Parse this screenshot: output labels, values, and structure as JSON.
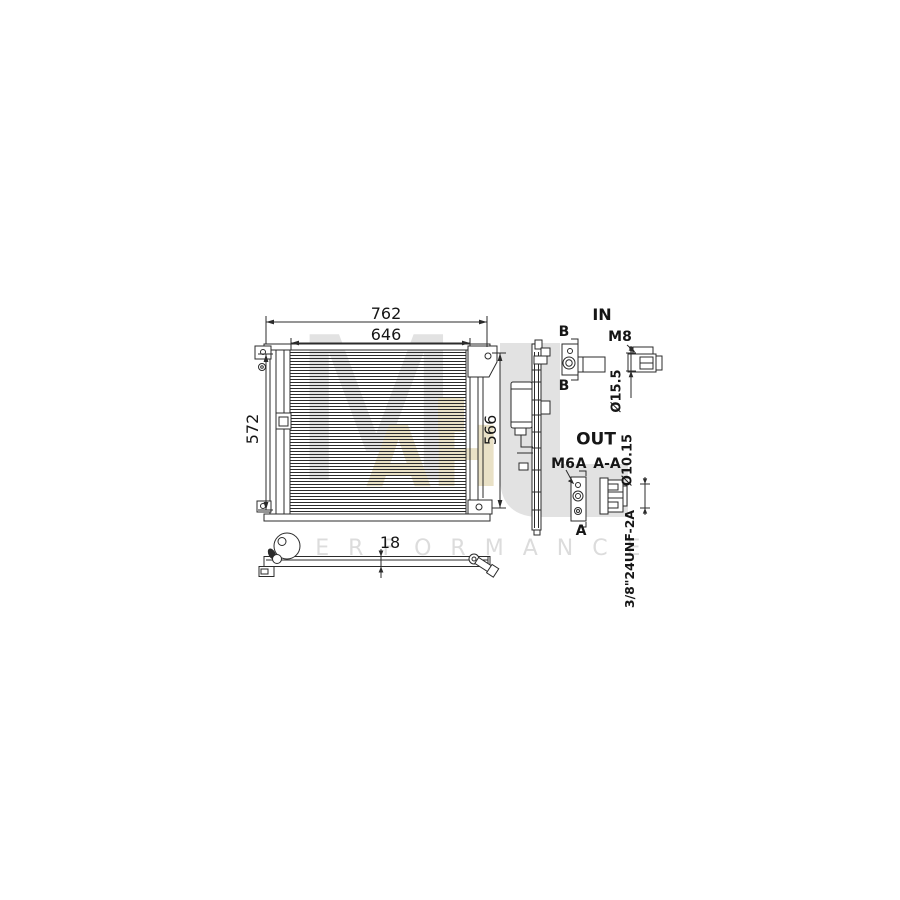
{
  "drawing": {
    "dim_overall_width": "762",
    "dim_core_width": "646",
    "dim_left_height": "572",
    "dim_right_height": "566",
    "dim_depth": "18",
    "inlet": {
      "title": "IN",
      "section_top": "B",
      "section_bottom": "B",
      "thread": "M8",
      "diameter": "Ø15.5"
    },
    "outlet": {
      "title": "OUT",
      "thread": "M6",
      "section_top": "A",
      "section_bottom": "A",
      "section_view": "A-A",
      "diameter": "Ø10.15",
      "fitting_thread": "3/8\"24UNF-2A"
    }
  },
  "watermark": {
    "letter_m": "M",
    "letters_ah": "AH",
    "performance": "PERFORMANCE"
  },
  "colors": {
    "line": "#2b2b2b",
    "watermark_gray": "#e2e2e2",
    "watermark_beige": "#e9e1c6",
    "watermark_text": "#dcdcdc"
  }
}
